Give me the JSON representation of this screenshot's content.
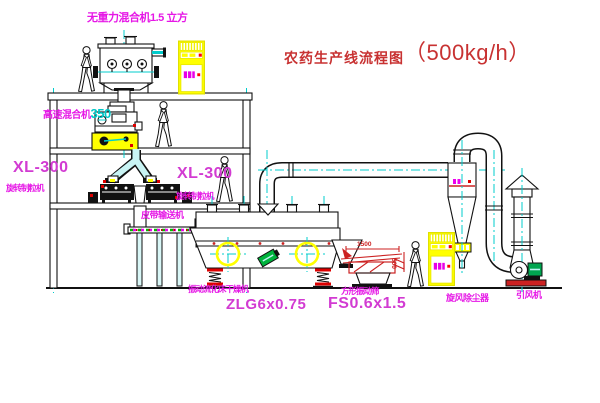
{
  "diagram": {
    "title": {
      "text": "农药生产线流程图",
      "capacity": "（500kg/h）"
    },
    "equipment": {
      "gravity_mixer": {
        "label": "无重力混合机1.5 立方"
      },
      "high_speed_mixer": {
        "label": "高速混合机",
        "model": "350"
      },
      "granulator_left": {
        "model": "XL-300",
        "name": "旋转制粒机"
      },
      "granulator_right": {
        "model": "XL-300",
        "name": "旋转制粒机"
      },
      "belt_conveyor": {
        "name": "皮带输送机"
      },
      "fluid_bed_dryer": {
        "name": "振动流化床干燥机",
        "model": "ZLG6x0.75"
      },
      "vibrating_sieve": {
        "name": "方形振动筛",
        "model": "FS0.6x1.5",
        "dim_width": "1500",
        "dim_height": "500"
      },
      "cyclone": {
        "name": "旋风除尘器"
      },
      "induced_draft_fan": {
        "name": "引风机"
      }
    },
    "colors": {
      "label_magenta": "#e617e6",
      "model_pink": "#d23bd2",
      "title_red": "#c83232",
      "centerline_cyan": "#00cccc",
      "highlight_yellow": "#ffff00",
      "machine_green": "#00a550",
      "alert_red": "#dd0000"
    }
  }
}
